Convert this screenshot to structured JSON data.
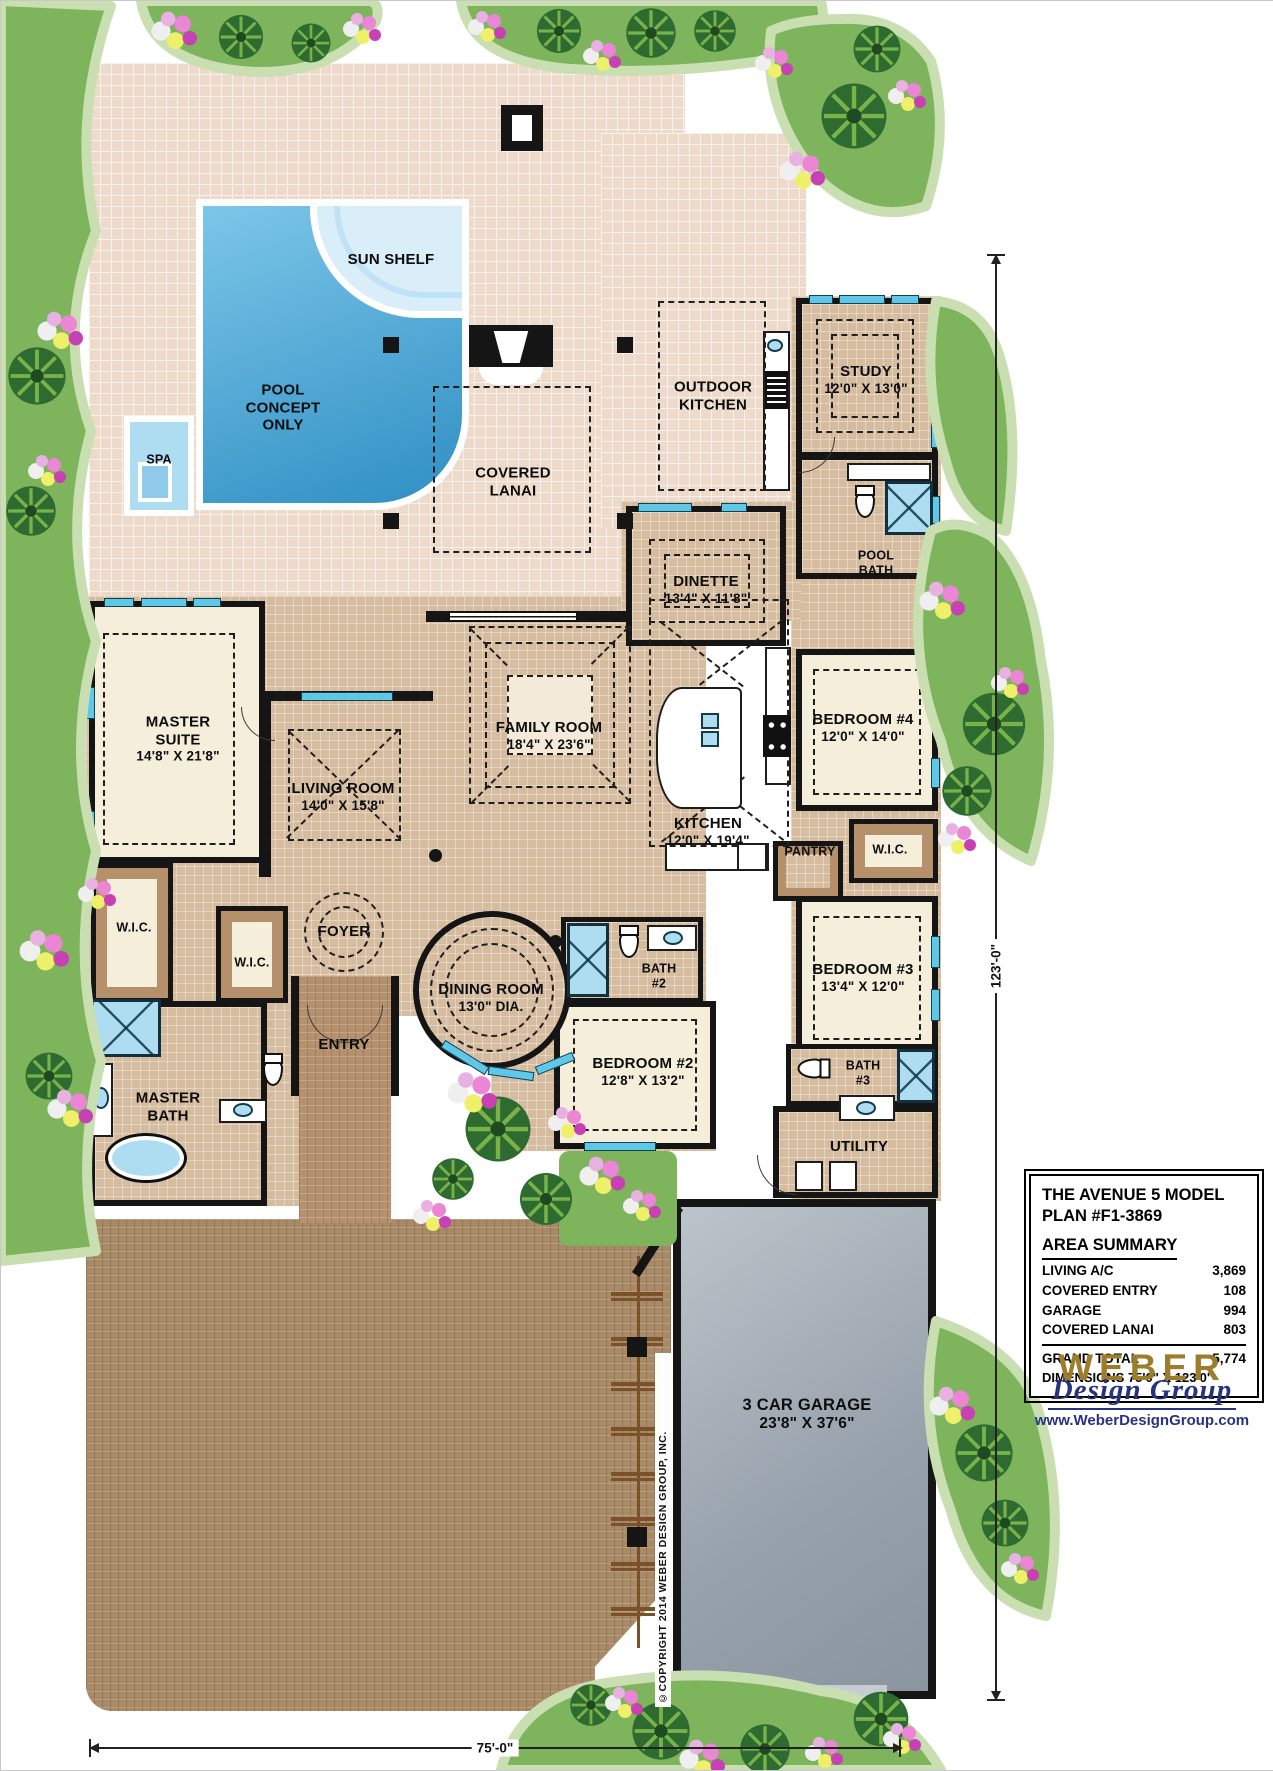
{
  "colors": {
    "wall": "#151515",
    "deck": "#eedacb",
    "tile": "#d6bc9e",
    "carpet": "#f5eeda",
    "window": "#5fc8e9",
    "pool_light": "#7cc6e8",
    "pool_deep": "#2f8fc4",
    "sun_shelf": "#d9eef8",
    "spa": "#aedcf1",
    "paver": "#a98a67",
    "walk": "#b5916d",
    "cabinet": "#b5906a",
    "grass": "#7db45c",
    "grass_edge": "#c9dfb2",
    "palm": "#2e6b31",
    "frond": "#7ab24a",
    "gold": "#9c7d2c",
    "blue": "#27337f"
  },
  "rooms": {
    "sun_shelf": {
      "name": "SUN SHELF"
    },
    "pool": {
      "name": "POOL\nCONCEPT\nONLY"
    },
    "spa": {
      "name": "SPA"
    },
    "covered_lanai": {
      "name": "COVERED\nLANAI"
    },
    "outdoor_kitchen": {
      "name": "OUTDOOR\nKITCHEN"
    },
    "study": {
      "name": "STUDY",
      "size": "12'0\" X 13'0\""
    },
    "pool_bath": {
      "name": "POOL\nBATH"
    },
    "dinette": {
      "name": "DINETTE",
      "size": "13'4\" X 11'8\""
    },
    "master_suite": {
      "name": "MASTER\nSUITE",
      "size": "14'8\" X 21'8\""
    },
    "living_room": {
      "name": "LIVING ROOM",
      "size": "14'0\" X 15'8\""
    },
    "family_room": {
      "name": "FAMILY ROOM",
      "size": "18'4\" X 23'6\""
    },
    "kitchen": {
      "name": "KITCHEN",
      "size": "12'0\" X 19'4\""
    },
    "bedroom4": {
      "name": "BEDROOM #4",
      "size": "12'0\" X 14'0\""
    },
    "wic_bed4": {
      "name": "W.I.C."
    },
    "pantry": {
      "name": "PANTRY"
    },
    "wic_master_1": {
      "name": "W.I.C."
    },
    "wic_master_2": {
      "name": "W.I.C."
    },
    "foyer": {
      "name": "FOYER"
    },
    "dining_room": {
      "name": "DINING ROOM",
      "size": "13'0\" DIA."
    },
    "bath2": {
      "name": "BATH\n#2"
    },
    "bedroom3": {
      "name": "BEDROOM #3",
      "size": "13'4\" X 12'0\""
    },
    "entry": {
      "name": "ENTRY"
    },
    "master_bath": {
      "name": "MASTER\nBATH"
    },
    "bedroom2": {
      "name": "BEDROOM #2",
      "size": "12'8\" X 13'2\""
    },
    "bath3": {
      "name": "BATH\n#3"
    },
    "utility": {
      "name": "UTILITY"
    },
    "garage": {
      "name": "3 CAR GARAGE",
      "size": "23'8\" X 37'6\""
    }
  },
  "summary": {
    "title": "THE AVENUE 5 MODEL\nPLAN #F1-3869",
    "heading": "AREA SUMMARY",
    "rows": [
      {
        "label": "LIVING A/C",
        "value": "3,869"
      },
      {
        "label": "COVERED ENTRY",
        "value": "108"
      },
      {
        "label": "GARAGE",
        "value": "994"
      },
      {
        "label": "COVERED LANAI",
        "value": "803"
      }
    ],
    "total_label": "GRAND TOTAL",
    "total_value": "5,774",
    "dims_line": "DIMENSIONS 75'0\" X 123'0\""
  },
  "logo": {
    "brand": "WEBER",
    "script": "Design Group",
    "url": "www.WeberDesignGroup.com"
  },
  "dims": {
    "right": "123'-0\"",
    "bottom": "75'-0\""
  },
  "copyright": "©COPYRIGHT 2014 WEBER DESIGN GROUP, INC."
}
